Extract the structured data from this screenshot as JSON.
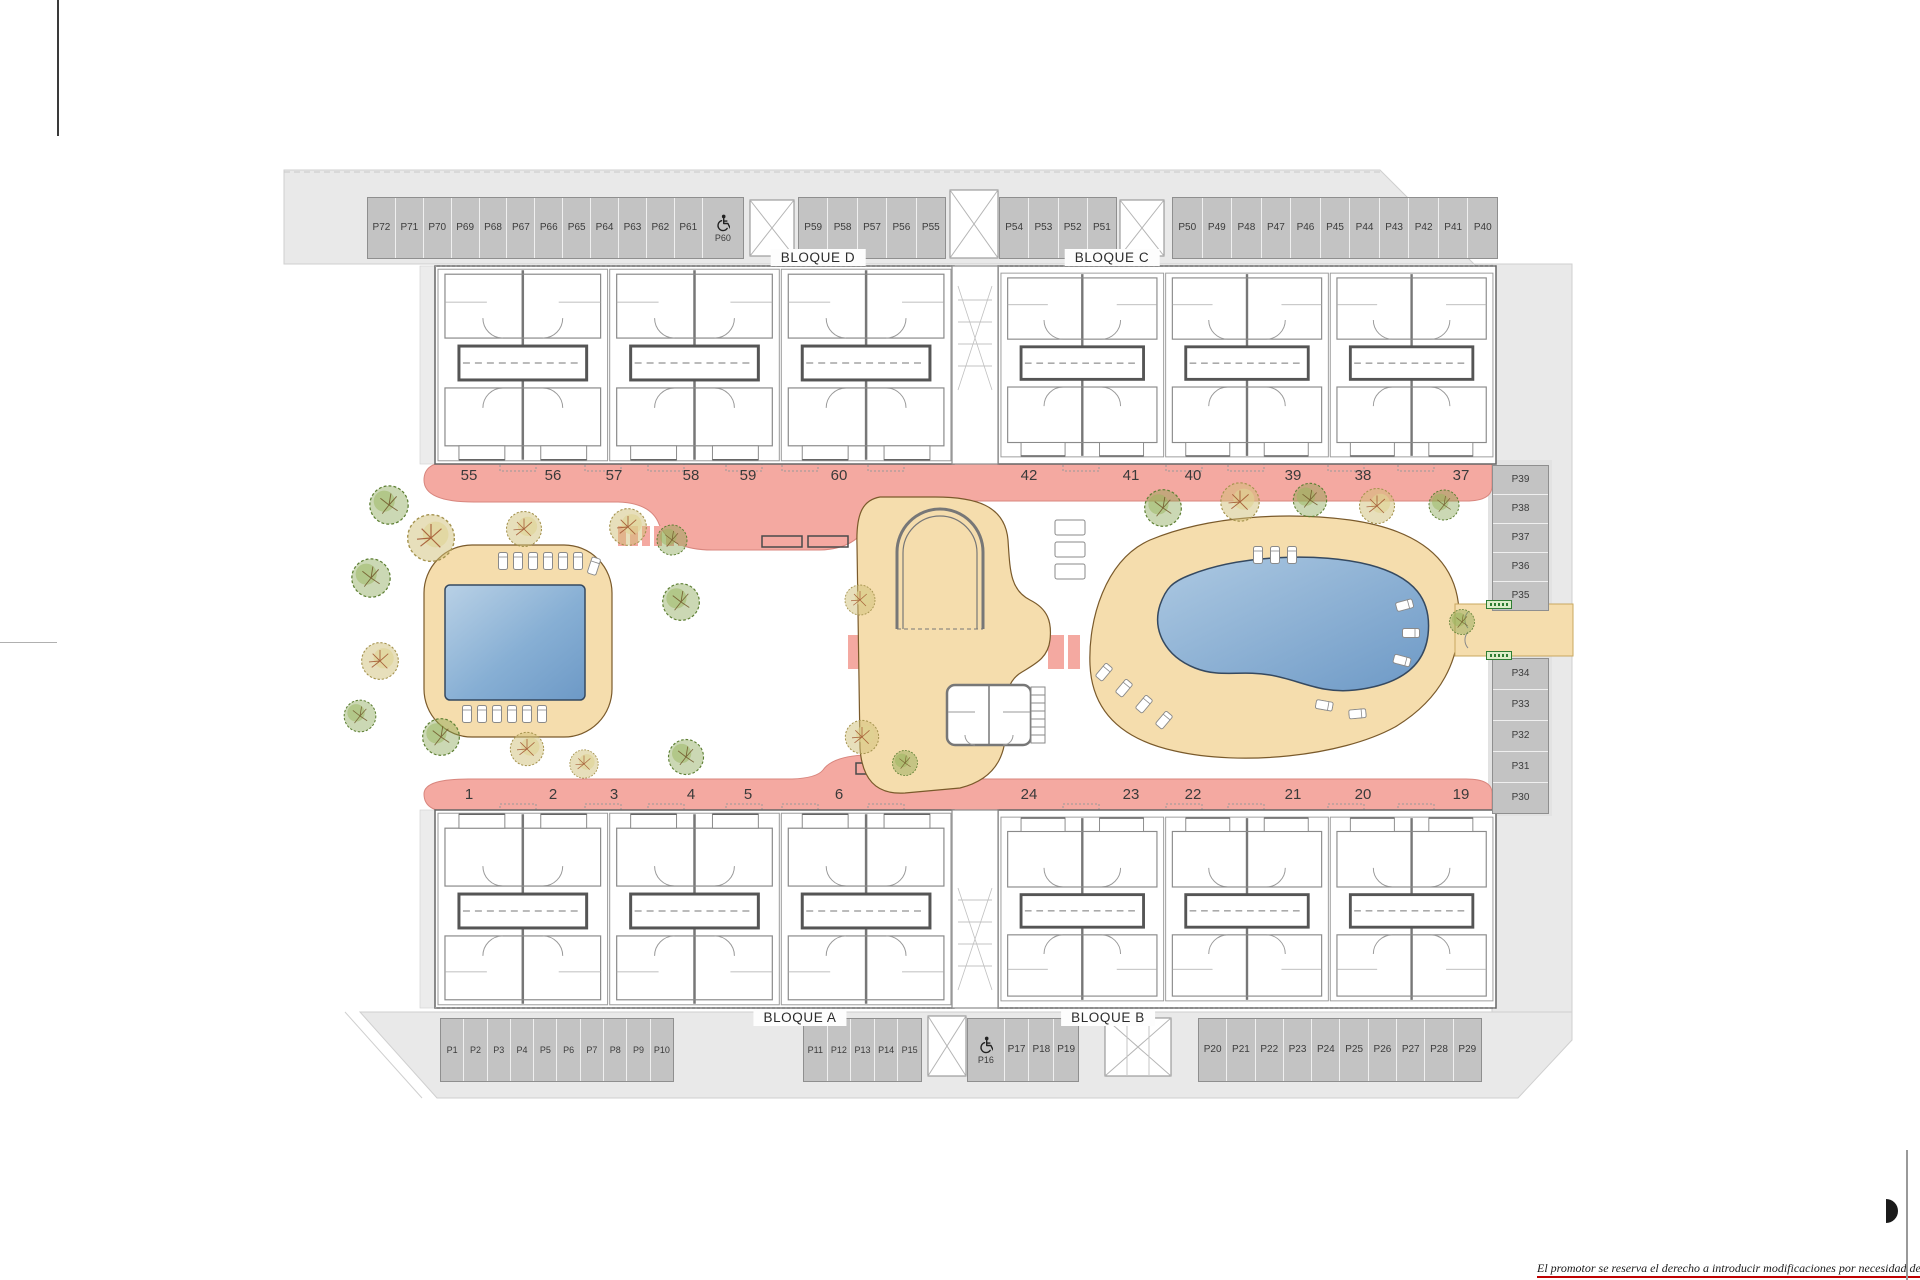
{
  "plan": {
    "blocks": [
      {
        "id": "d",
        "label": "BLOQUE D"
      },
      {
        "id": "c",
        "label": "BLOQUE C"
      },
      {
        "id": "a",
        "label": "BLOQUE A"
      },
      {
        "id": "b",
        "label": "BLOQUE B"
      }
    ],
    "unit_numbers": {
      "top_left": [
        "55",
        "56",
        "57",
        "58",
        "59",
        "60"
      ],
      "top_right": [
        "42",
        "41",
        "40",
        "39",
        "38",
        "37"
      ],
      "bottom_left": [
        "1",
        "2",
        "3",
        "4",
        "5",
        "6"
      ],
      "bottom_right": [
        "24",
        "23",
        "22",
        "21",
        "20",
        "19"
      ]
    },
    "parking": {
      "groups": [
        {
          "key": "t1",
          "labels": [
            "P72",
            "P71",
            "P70",
            "P69",
            "P68",
            "P67",
            "P66",
            "P65",
            "P64",
            "P63",
            "P62",
            "P61",
            "P60"
          ],
          "handicap": "P60"
        },
        {
          "key": "t2",
          "labels": [
            "P59",
            "P58",
            "P57",
            "P56",
            "P55"
          ]
        },
        {
          "key": "t3",
          "labels": [
            "P54",
            "P53",
            "P52",
            "P51"
          ]
        },
        {
          "key": "t4",
          "labels": [
            "P50",
            "P49",
            "P48",
            "P47",
            "P46",
            "P45",
            "P44",
            "P43",
            "P42",
            "P41",
            "P40"
          ]
        },
        {
          "key": "b1",
          "labels": [
            "P1",
            "P2",
            "P3",
            "P4",
            "P5",
            "P6",
            "P7",
            "P8",
            "P9",
            "P10"
          ]
        },
        {
          "key": "b2",
          "labels": [
            "P11",
            "P12",
            "P13",
            "P14",
            "P15"
          ]
        },
        {
          "key": "b3",
          "labels": [
            "P16",
            "P17",
            "P18",
            "P19"
          ],
          "handicap": "P16"
        },
        {
          "key": "b4",
          "labels": [
            "P20",
            "P21",
            "P22",
            "P23",
            "P24",
            "P25",
            "P26",
            "P27",
            "P28",
            "P29"
          ]
        },
        {
          "key": "r1",
          "labels": [
            "P39",
            "P38",
            "P37",
            "P36",
            "P35"
          ]
        },
        {
          "key": "r2",
          "labels": [
            "P34",
            "P33",
            "P32",
            "P31",
            "P30"
          ]
        }
      ]
    },
    "disclaimer": "El promotor se reserva el derecho a introducir modificaciones por necesidad de índole técnica o legal",
    "colors": {
      "walkway": "#f4a9a1",
      "deck": "#f5ddad",
      "pool_light": "#aac7e2",
      "pool_dark": "#6d99c6",
      "paving": "#e9e9e9",
      "stall": "#c3c3c3",
      "accent_red": "#c00000"
    }
  }
}
